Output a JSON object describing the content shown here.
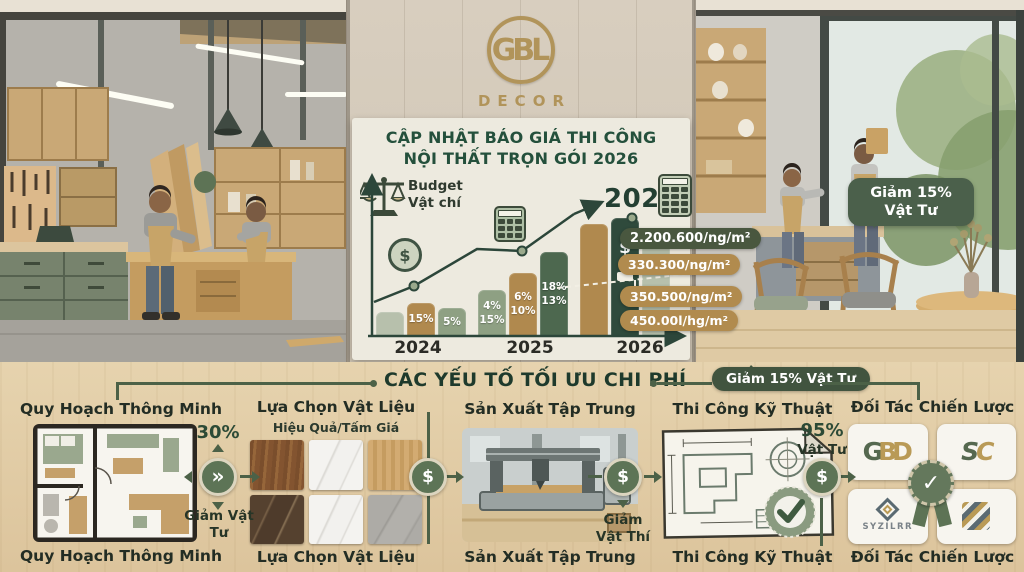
{
  "logo": {
    "monogram": "GBL",
    "brand": "DECOR"
  },
  "header": {
    "title_line1": "CẬP NHẬT BÁO GIÁ THI CÔNG",
    "title_line2": "NỘI THẤT TRỌN GÓI 2026"
  },
  "icons": {
    "dollar": "$",
    "chevrons": "»",
    "check": "✓"
  },
  "chart_data": {
    "type": "bar",
    "title": "CẬP NHẬT BÁO GIÁ THI CÔNG NỘI THẤT TRỌN GÓI 2026",
    "categories": [
      "2024",
      "2025",
      "2026"
    ],
    "xlabel": "",
    "ylabel": "",
    "annotations": {
      "budget_line1": "Budget",
      "budget_line2": "Vật chí",
      "target_year": "2026"
    },
    "groups": [
      {
        "year": "2024",
        "bars": [
          {
            "h": 24,
            "color": "sage_light",
            "labels": []
          },
          {
            "h": 33,
            "color": "tan",
            "labels": [
              "15%"
            ]
          },
          {
            "h": 28,
            "color": "sage",
            "labels": [
              "5%"
            ]
          }
        ]
      },
      {
        "year": "2025",
        "bars": [
          {
            "h": 46,
            "color": "sage",
            "labels": [
              "4%",
              "15%"
            ]
          },
          {
            "h": 63,
            "color": "tan",
            "labels": [
              "6%",
              "10%"
            ]
          },
          {
            "h": 84,
            "color": "green",
            "labels": [
              "18%",
              "13%"
            ]
          }
        ]
      },
      {
        "year": "2026",
        "bars": [
          {
            "h": 112,
            "color": "tan",
            "labels": []
          },
          {
            "h": 118,
            "color": "dark",
            "labels": [],
            "icons": [
              "dollar",
              "paint"
            ]
          },
          {
            "h": 108,
            "color": "sage_light",
            "labels": []
          }
        ]
      }
    ],
    "trend": {
      "path": [
        [
          22,
          132
        ],
        [
          62,
          116
        ],
        [
          125,
          79
        ],
        [
          170,
          81
        ],
        [
          222,
          44
        ]
      ],
      "arrow_to": [
        248,
        33
      ],
      "dots": [
        [
          62,
          116
        ],
        [
          170,
          81
        ],
        [
          280,
          48
        ]
      ],
      "dashed": [
        [
          205,
          118
        ],
        [
          336,
          104
        ]
      ]
    },
    "price_tags": [
      {
        "text": "2.200.600/ng/m²",
        "style": "dark"
      },
      {
        "text": "330.300/ng/m²",
        "style": "tan"
      },
      {
        "text": "350.500/ng/m²",
        "style": "tan"
      },
      {
        "text": "450.00l/hg/m²",
        "style": "tan"
      }
    ]
  },
  "right_panel": {
    "badge": "Giảm 15% Vật Tư"
  },
  "bottom": {
    "section_title": "CÁC YẾU TỐ TỐI ƯU CHI PHÍ",
    "badge": "Giảm 15% Vật Tư",
    "columns": [
      {
        "top": "Quy Hoạch Thông Minh",
        "bottom": "Quy Hoạch Thông Minh"
      },
      {
        "top": "Lựa Chọn Vật Liệu",
        "subtitle": "Hiệu Quả/Tấm Giá",
        "bottom": "Lựa Chọn Vật Liệu"
      },
      {
        "top": "Sản Xuất Tập Trung",
        "bottom": "Sản Xuất Tập Trung"
      },
      {
        "top": "Thi Công Kỹ Thuật",
        "bottom": "Thi Công Kỹ Thuật"
      },
      {
        "top": "Đối Tác Chiến Lược",
        "bottom": "Đối Tác Chiến Lược"
      }
    ],
    "connectors": [
      {
        "pct": "30%",
        "caption": "Giảm Vật Tư"
      },
      {
        "pct": "",
        "caption": ""
      },
      {
        "pct": "",
        "caption": "Giảm Vật Thí"
      },
      {
        "pct": "95%",
        "caption": "Vật Tư"
      }
    ],
    "partners": {
      "logo1_letters": [
        "G",
        "B",
        "D"
      ],
      "logo2_letters": [
        "S",
        "C"
      ],
      "logo3_text": "SYZILRR"
    }
  },
  "colors": {
    "brand_gold": "#b1945a",
    "dark_green": "#24503c",
    "sage": "#8ea083",
    "tan": "#b0894e",
    "wood_bg": "#e0cba4",
    "pill_dark": "#49573f",
    "pill_tan": "#b18b4e"
  }
}
